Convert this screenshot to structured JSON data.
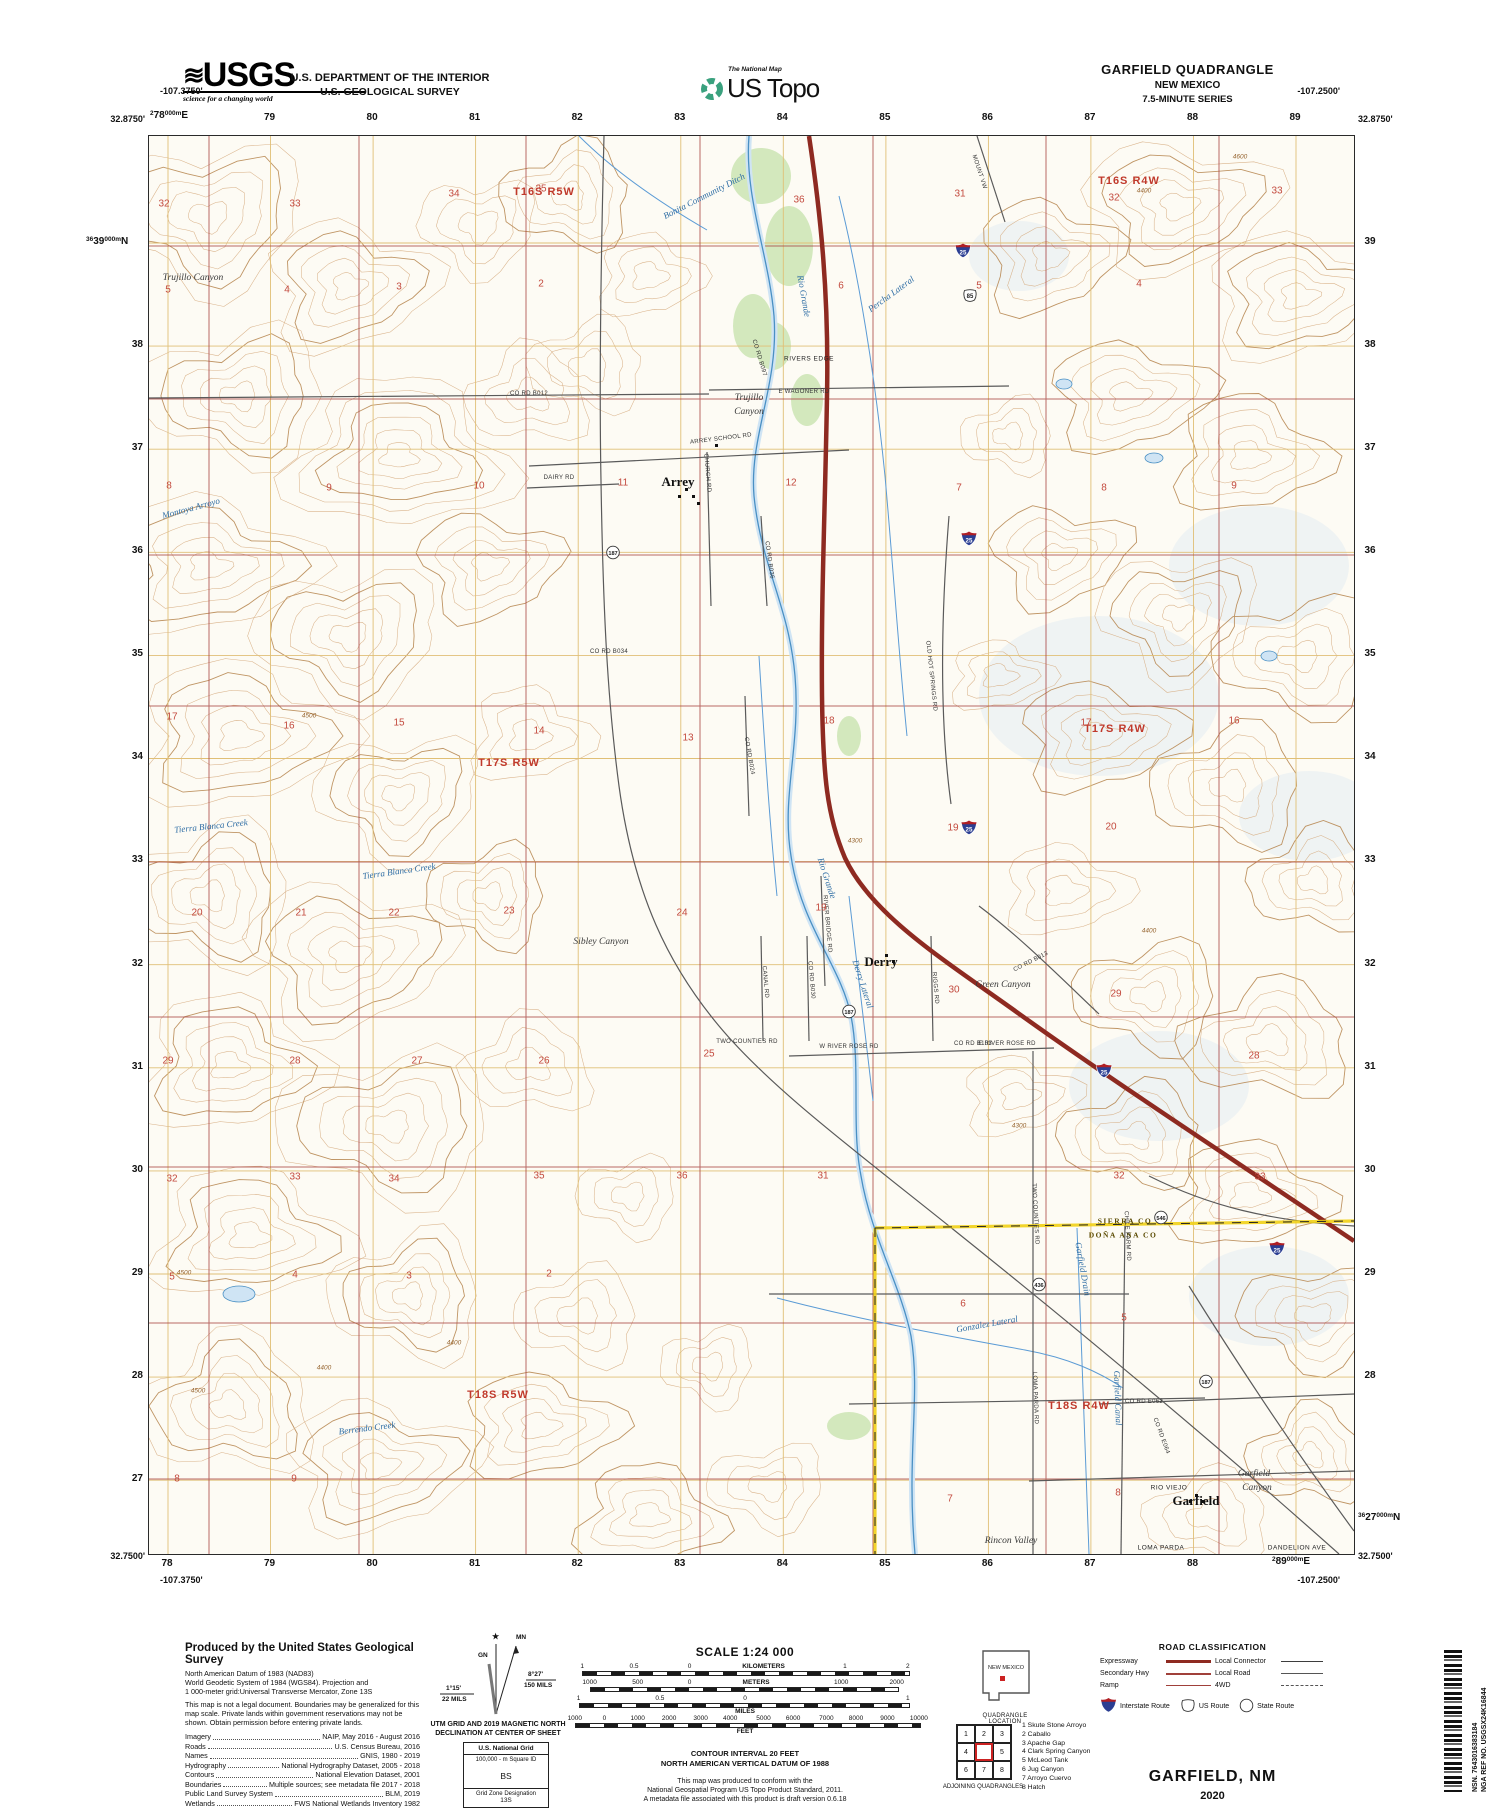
{
  "colors": {
    "interstate": "#8e2a21",
    "contour_light": "#d6ac80",
    "contour_index": "#b98a55",
    "water": "#4a90c4",
    "water_fill": "#cfe4f4",
    "utm_grid": "#e0bf76",
    "section_grid": "#a94442",
    "section_number": "#c34a3e",
    "veg": "#d3e8bd",
    "county_line": "#f1d016",
    "township_red": "#c0392b",
    "usgs_green": "#3aa17e"
  },
  "header": {
    "usgs": "USGS",
    "usgs_tagline": "science for a changing world",
    "dept1": "U.S. DEPARTMENT OF THE INTERIOR",
    "dept2": "U.S. GEOLOGICAL SURVEY",
    "natmap": "The National Map",
    "ustopo": "US Topo",
    "quad": "GARFIELD QUADRANGLE",
    "state": "NEW MEXICO",
    "series": "7.5-MINUTE SERIES"
  },
  "edges": {
    "tl_lon": "-107.3750'",
    "tl_lat": "32.8750'",
    "tr_lon": "-107.2500'",
    "tr_lat": "32.8750'",
    "bl_lat": "32.7500'",
    "bl_lon": "-107.3750'",
    "br_lat": "32.7500'",
    "br_lon": "-107.2500'",
    "top_first": {
      "p": "2",
      "m": "78",
      "s": "000m",
      "d": "E"
    },
    "top": [
      "79",
      "80",
      "81",
      "82",
      "83",
      "84",
      "85",
      "86",
      "87",
      "88",
      "89"
    ],
    "bottom": [
      "78",
      "79",
      "80",
      "81",
      "82",
      "83",
      "84",
      "85",
      "86",
      "87",
      "88"
    ],
    "bottom_last": {
      "p": "2",
      "m": "89",
      "s": "000m",
      "d": "E"
    },
    "left_first": {
      "p": "36",
      "m": "39",
      "s": "000m",
      "d": "N"
    },
    "left": [
      "38",
      "37",
      "36",
      "35",
      "34",
      "33",
      "32",
      "31",
      "30",
      "29",
      "28",
      "27"
    ],
    "right": [
      "39",
      "38",
      "37",
      "36",
      "35",
      "34",
      "33",
      "32",
      "31",
      "30",
      "29",
      "28"
    ],
    "right_last": {
      "p": "36",
      "m": "27",
      "s": "000m",
      "d": "N"
    }
  },
  "map": {
    "townships": [
      {
        "t": "T16S R5W",
        "x": 395,
        "y": 56
      },
      {
        "t": "T16S R4W",
        "x": 980,
        "y": 45
      },
      {
        "t": "T17S R5W",
        "x": 360,
        "y": 627
      },
      {
        "t": "T17S R4W",
        "x": 966,
        "y": 593
      },
      {
        "t": "T18S R5W",
        "x": 349,
        "y": 1259
      },
      {
        "t": "T18S R4W",
        "x": 930,
        "y": 1270
      }
    ],
    "towns": [
      {
        "t": "Arrey",
        "x": 529,
        "y": 346
      },
      {
        "t": "Derry",
        "x": 732,
        "y": 826
      },
      {
        "t": "Garfield",
        "x": 1047,
        "y": 1365
      }
    ],
    "water": [
      {
        "t": "Rio Grande",
        "x": 655,
        "y": 160,
        "r": 80
      },
      {
        "t": "Rio Grande",
        "x": 678,
        "y": 742,
        "r": 72
      },
      {
        "t": "Bonita Community Ditch",
        "x": 555,
        "y": 60,
        "r": -27
      },
      {
        "t": "Percha Lateral",
        "x": 742,
        "y": 158,
        "r": -36
      },
      {
        "t": "Montoya Arroyo",
        "x": 42,
        "y": 372,
        "r": -15
      },
      {
        "t": "Tierra Blanca Creek",
        "x": 62,
        "y": 690,
        "r": -6
      },
      {
        "t": "Tierra Blanca Creek",
        "x": 250,
        "y": 735,
        "r": -8
      },
      {
        "t": "Berrendo Creek",
        "x": 218,
        "y": 1292,
        "r": -7
      },
      {
        "t": "Derry Lateral",
        "x": 714,
        "y": 848,
        "r": 72
      },
      {
        "t": "Garfield Drain",
        "x": 934,
        "y": 1133,
        "r": 80
      },
      {
        "t": "Gonzalez Lateral",
        "x": 838,
        "y": 1188,
        "r": -10
      },
      {
        "t": "Garfield Canal",
        "x": 969,
        "y": 1262,
        "r": 88
      }
    ],
    "landforms": [
      {
        "t": "Trujillo Canyon",
        "x": 44,
        "y": 142
      },
      {
        "t": "Trujillo",
        "x": 600,
        "y": 262
      },
      {
        "t": "Canyon",
        "x": 600,
        "y": 276
      },
      {
        "t": "Sibley Canyon",
        "x": 452,
        "y": 806
      },
      {
        "t": "Green Canyon",
        "x": 854,
        "y": 849
      },
      {
        "t": "Garfield",
        "x": 1105,
        "y": 1338
      },
      {
        "t": "Canyon",
        "x": 1108,
        "y": 1352
      },
      {
        "t": "Rincon Valley",
        "x": 862,
        "y": 1405
      }
    ],
    "caps": [
      {
        "t": "LOMA PARDA",
        "x": 1012,
        "y": 1412
      },
      {
        "t": "DANDELION AVE",
        "x": 1148,
        "y": 1412
      },
      {
        "t": "RIO VIEJO",
        "x": 1020,
        "y": 1352
      },
      {
        "t": "RIVERS EDGE",
        "x": 660,
        "y": 223
      }
    ],
    "county": [
      {
        "t": "SIERRA CO",
        "x": 976,
        "y": 1085
      },
      {
        "t": "DOÑA ANA CO",
        "x": 974,
        "y": 1099
      }
    ],
    "roads": [
      {
        "t": "CO RD B012",
        "x": 380,
        "y": 258,
        "r": 0
      },
      {
        "t": "E WAGONER RD",
        "x": 655,
        "y": 256,
        "r": 0
      },
      {
        "t": "ARREY SCHOOL RD",
        "x": 572,
        "y": 303,
        "r": -7
      },
      {
        "t": "CHURCH RD",
        "x": 558,
        "y": 337,
        "r": 85
      },
      {
        "t": "CO RD B097",
        "x": 610,
        "y": 222,
        "r": 73
      },
      {
        "t": "DAIRY RD",
        "x": 410,
        "y": 342,
        "r": 0
      },
      {
        "t": "CO RD B036",
        "x": 620,
        "y": 424,
        "r": 82
      },
      {
        "t": "CO RD B034",
        "x": 460,
        "y": 516,
        "r": 0
      },
      {
        "t": "CO RD B024",
        "x": 600,
        "y": 620,
        "r": 80
      },
      {
        "t": "OLD HOT SPRINGS RD",
        "x": 782,
        "y": 540,
        "r": 84
      },
      {
        "t": "MOUNT VW",
        "x": 830,
        "y": 36,
        "r": 72
      },
      {
        "t": "RIVER BRIDGE RD",
        "x": 678,
        "y": 788,
        "r": 85
      },
      {
        "t": "CO RD B013",
        "x": 882,
        "y": 826,
        "r": -27
      },
      {
        "t": "CO RD B103",
        "x": 824,
        "y": 908,
        "r": 0
      },
      {
        "t": "W RIVER ROSE RD",
        "x": 700,
        "y": 911,
        "r": 0
      },
      {
        "t": "E RIVER ROSE RD",
        "x": 858,
        "y": 908,
        "r": 0
      },
      {
        "t": "RIGGS RD",
        "x": 786,
        "y": 852,
        "r": 85
      },
      {
        "t": "CANAL RD",
        "x": 616,
        "y": 846,
        "r": 85
      },
      {
        "t": "CO RD B030",
        "x": 662,
        "y": 844,
        "r": 85
      },
      {
        "t": "TWO COUNTIES RD",
        "x": 598,
        "y": 906,
        "r": 0
      },
      {
        "t": "TWO COUNTIES RD",
        "x": 886,
        "y": 1078,
        "r": 87
      },
      {
        "t": "CHILE FARM RD",
        "x": 978,
        "y": 1100,
        "r": 87
      },
      {
        "t": "LOMA PARDA RD",
        "x": 886,
        "y": 1262,
        "r": 88
      },
      {
        "t": "CO RD E062",
        "x": 995,
        "y": 1266,
        "r": 0
      },
      {
        "t": "CO RD E064",
        "x": 1012,
        "y": 1300,
        "r": 70
      }
    ],
    "sections": [
      [
        32,
        15,
        68
      ],
      [
        33,
        146,
        68
      ],
      [
        34,
        305,
        58
      ],
      [
        35,
        392,
        53
      ],
      [
        36,
        650,
        64
      ],
      [
        31,
        811,
        58
      ],
      [
        32,
        965,
        62
      ],
      [
        33,
        1128,
        55
      ],
      [
        5,
        19,
        154
      ],
      [
        4,
        138,
        154
      ],
      [
        3,
        250,
        151
      ],
      [
        2,
        392,
        148
      ],
      [
        6,
        692,
        150
      ],
      [
        5,
        830,
        150
      ],
      [
        4,
        990,
        148
      ],
      [
        8,
        20,
        350
      ],
      [
        9,
        180,
        352
      ],
      [
        10,
        330,
        350
      ],
      [
        11,
        474,
        347
      ],
      [
        12,
        642,
        347
      ],
      [
        7,
        810,
        352
      ],
      [
        8,
        955,
        352
      ],
      [
        9,
        1085,
        350
      ],
      [
        17,
        23,
        581
      ],
      [
        16,
        140,
        590
      ],
      [
        15,
        250,
        587
      ],
      [
        14,
        390,
        595
      ],
      [
        13,
        539,
        602
      ],
      [
        18,
        680,
        585
      ],
      [
        17,
        937,
        587
      ],
      [
        16,
        1085,
        585
      ],
      [
        20,
        48,
        777
      ],
      [
        21,
        152,
        777
      ],
      [
        22,
        245,
        777
      ],
      [
        23,
        360,
        775
      ],
      [
        24,
        533,
        777
      ],
      [
        19,
        672,
        772
      ],
      [
        19,
        804,
        692
      ],
      [
        20,
        962,
        691
      ],
      [
        29,
        19,
        925
      ],
      [
        28,
        146,
        925
      ],
      [
        27,
        268,
        925
      ],
      [
        26,
        395,
        925
      ],
      [
        25,
        560,
        918
      ],
      [
        30,
        805,
        854
      ],
      [
        29,
        967,
        858
      ],
      [
        28,
        1105,
        920
      ],
      [
        32,
        23,
        1043
      ],
      [
        33,
        146,
        1041
      ],
      [
        34,
        245,
        1043
      ],
      [
        35,
        390,
        1040
      ],
      [
        36,
        533,
        1040
      ],
      [
        31,
        674,
        1040
      ],
      [
        32,
        970,
        1040
      ],
      [
        33,
        1111,
        1041
      ],
      [
        5,
        23,
        1141
      ],
      [
        4,
        146,
        1139
      ],
      [
        3,
        260,
        1140
      ],
      [
        2,
        400,
        1138
      ],
      [
        6,
        814,
        1168
      ],
      [
        5,
        975,
        1182
      ],
      [
        8,
        28,
        1343
      ],
      [
        9,
        145,
        1343
      ],
      [
        7,
        801,
        1363
      ],
      [
        8,
        969,
        1357
      ]
    ],
    "contours": [
      [
        "4500",
        35,
        1137
      ],
      [
        "4400",
        175,
        1232
      ],
      [
        "4600",
        1091,
        21
      ],
      [
        "4300",
        706,
        705
      ],
      [
        "4400",
        1000,
        795
      ],
      [
        "4500",
        49,
        1255
      ],
      [
        "4400",
        305,
        1207
      ],
      [
        "4400",
        995,
        55
      ],
      [
        "4500",
        160,
        580
      ],
      [
        "4300",
        870,
        990
      ]
    ],
    "shields": [
      {
        "k": "i",
        "n": "25",
        "x": 814,
        "y": 117
      },
      {
        "k": "i",
        "n": "25",
        "x": 820,
        "y": 405
      },
      {
        "k": "i",
        "n": "25",
        "x": 820,
        "y": 694
      },
      {
        "k": "i",
        "n": "25",
        "x": 955,
        "y": 937
      },
      {
        "k": "i",
        "n": "25",
        "x": 1128,
        "y": 1115
      },
      {
        "k": "u",
        "n": "85",
        "x": 821,
        "y": 162
      },
      {
        "k": "s",
        "n": "187",
        "x": 464,
        "y": 419
      },
      {
        "k": "s",
        "n": "187",
        "x": 700,
        "y": 878
      },
      {
        "k": "s",
        "n": "187",
        "x": 1057,
        "y": 1248
      },
      {
        "k": "s",
        "n": "436",
        "x": 890,
        "y": 1151
      },
      {
        "k": "s",
        "n": "546",
        "x": 1012,
        "y": 1084
      }
    ]
  },
  "footer": {
    "credits": {
      "title": "Produced by the United States Geological Survey",
      "datum1": "North American Datum of 1983 (NAD83)",
      "datum2": "World Geodetic System of 1984 (WGS84).  Projection and",
      "datum3": "1 000-meter grid:Universal Transverse Mercator, Zone 13S",
      "legal": "This map is not a legal document. Boundaries may be generalized for this map scale. Private lands within government reservations may not be shown. Obtain permission before entering private lands.",
      "sources": [
        {
          "k": "Imagery",
          "v": "NAIP, May 2016 - August 2016"
        },
        {
          "k": "Roads",
          "v": "U.S. Census Bureau, 2016"
        },
        {
          "k": "Names",
          "v": "GNIS, 1980 - 2019"
        },
        {
          "k": "Hydrography",
          "v": "National Hydrography Dataset, 2005 - 2018"
        },
        {
          "k": "Contours",
          "v": "National Elevation Dataset, 2001"
        },
        {
          "k": "Boundaries",
          "v": "Multiple sources; see metadata file 2017 - 2018"
        },
        {
          "k": "Public Land Survey System",
          "v": "BLM, 2019"
        },
        {
          "k": "Wetlands",
          "v": "FWS National Wetlands Inventory 1982"
        }
      ]
    },
    "declination": {
      "star": "★",
      "mn": "MN",
      "gn": "GN",
      "right_deg": "8°27'",
      "right_mils": "150 MILS",
      "left_deg": "1°15'",
      "left_mils": "22 MILS",
      "cap1": "UTM GRID AND 2019 MAGNETIC NORTH",
      "cap2": "DECLINATION AT CENTER OF SHEET"
    },
    "usng": {
      "title": "U.S. National Grid",
      "sub": "100,000 - m Square ID",
      "square": "BS",
      "zl": "Grid Zone Designation",
      "zone": "13S"
    },
    "scale": {
      "title": "SCALE 1:24 000",
      "rows": [
        {
          "labels": [
            {
              "t": "1",
              "p": 6
            },
            {
              "t": "0.5",
              "p": 20
            },
            {
              "t": "0",
              "p": 35
            },
            {
              "t": "KILOMETERS",
              "p": 55,
              "w": 1
            },
            {
              "t": "1",
              "p": 77
            },
            {
              "t": "2",
              "p": 94
            }
          ],
          "bar": [
            6,
            94
          ]
        },
        {
          "labels": [
            {
              "t": "1000",
              "p": 8
            },
            {
              "t": "500",
              "p": 21
            },
            {
              "t": "0",
              "p": 35
            },
            {
              "t": "METERS",
              "p": 53,
              "w": 1
            },
            {
              "t": "1000",
              "p": 76
            },
            {
              "t": "2000",
              "p": 91
            }
          ],
          "bar": [
            8,
            91
          ]
        },
        {
          "labels": [
            {
              "t": "1",
              "p": 5
            },
            {
              "t": "0.5",
              "p": 27
            },
            {
              "t": "0",
              "p": 50
            },
            {
              "t": "1",
              "p": 94
            }
          ],
          "bar": [
            5,
            94
          ],
          "unit": "MILES",
          "up": 50
        },
        {
          "labels": [
            {
              "t": "1000",
              "p": 4
            },
            {
              "t": "0",
              "p": 12
            },
            {
              "t": "1000",
              "p": 21
            },
            {
              "t": "2000",
              "p": 29.5
            },
            {
              "t": "3000",
              "p": 38
            },
            {
              "t": "4000",
              "p": 46
            },
            {
              "t": "5000",
              "p": 55
            },
            {
              "t": "6000",
              "p": 63
            },
            {
              "t": "7000",
              "p": 72
            },
            {
              "t": "8000",
              "p": 80
            },
            {
              "t": "9000",
              "p": 88.5
            },
            {
              "t": "10000",
              "p": 97
            }
          ],
          "bar": [
            4,
            97
          ],
          "unit": "FEET",
          "up": 50
        }
      ],
      "ci1": "CONTOUR INTERVAL 20 FEET",
      "ci2": "NORTH AMERICAN VERTICAL DATUM OF 1988",
      "n1": "This map was produced to conform with the",
      "n2": "National Geospatial Program US Topo Product Standard, 2011.",
      "n3": "A metadata file associated with this product is draft version 0.6.18"
    },
    "quadloc": {
      "state": "NEW MEXICO",
      "caption": "QUADRANGLE LOCATION"
    },
    "adjoining": {
      "cells": [
        "1",
        "2",
        "3",
        "4",
        "",
        "5",
        "6",
        "7",
        "8"
      ],
      "names": [
        "1 Skute Stone Arroyo",
        "2 Caballo",
        "3 Apache Gap",
        "4 Clark Spring Canyon",
        "5 McLeod Tank",
        "6 Jug Canyon",
        "7 Arroyo Cuervo",
        "8 Hatch"
      ],
      "caption": "ADJOINING QUADRANGLES"
    },
    "roadclass": {
      "title": "ROAD CLASSIFICATION",
      "col1": [
        {
          "t": "Expressway",
          "c": "l-exp"
        },
        {
          "t": "Secondary Hwy",
          "c": "l-sec"
        },
        {
          "t": "Ramp",
          "c": "l-ramp"
        }
      ],
      "col2": [
        {
          "t": "Local Connector",
          "c": "l-lc"
        },
        {
          "t": "Local Road",
          "c": "l-lr"
        },
        {
          "t": "4WD",
          "c": "l-4wd"
        }
      ],
      "interstate": "Interstate Route",
      "us": "US Route",
      "state": "State Route"
    },
    "mapname": "GARFIELD,  NM",
    "year": "2020",
    "barcode": {
      "nsn": "NSN. 7643016383184",
      "nga": "NGA REF NO. USGSX24K16844"
    }
  }
}
